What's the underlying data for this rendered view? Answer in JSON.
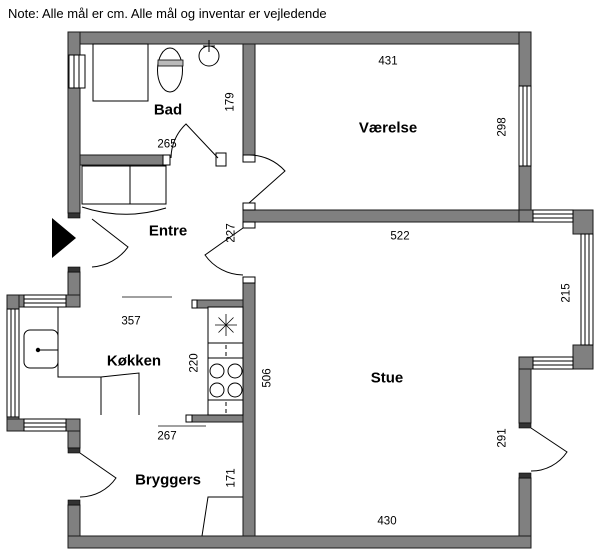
{
  "note": "Note: Alle mål er cm. Alle mål og inventar er vejledende",
  "rooms": [
    {
      "name": "Bad"
    },
    {
      "name": "Værelse"
    },
    {
      "name": "Entre"
    },
    {
      "name": "Køkken"
    },
    {
      "name": "Stue"
    },
    {
      "name": "Bryggers"
    }
  ],
  "dimensions_cm": [
    {
      "value": "431",
      "along": "Vaerelse top wall"
    },
    {
      "value": "298",
      "along": "Vaerelse right window wall"
    },
    {
      "value": "179",
      "along": "Bad right wall"
    },
    {
      "value": "265",
      "along": "Bad bottom wall"
    },
    {
      "value": "227",
      "along": "Entre right wall"
    },
    {
      "value": "522",
      "along": "Stue top wall"
    },
    {
      "value": "215",
      "along": "Stue bay right window wall"
    },
    {
      "value": "357",
      "along": "Koekken top opening"
    },
    {
      "value": "220",
      "along": "Koekken counter wall"
    },
    {
      "value": "506",
      "along": "Stue left wall"
    },
    {
      "value": "267",
      "along": "Bryggers top opening"
    },
    {
      "value": "171",
      "along": "Bryggers right wall"
    },
    {
      "value": "291",
      "along": "Stue right door wall"
    },
    {
      "value": "430",
      "along": "Stue bottom wall"
    }
  ],
  "fixtures": [
    "shower",
    "toilet",
    "washbasin",
    "wardrobe",
    "kitchen-sink",
    "counter-sink-star",
    "cooktop",
    "utility-appliance",
    "entrance-arrow"
  ],
  "colors": {
    "wall": "#808080",
    "line": "#000000",
    "background": "#ffffff",
    "text": "#000000"
  }
}
